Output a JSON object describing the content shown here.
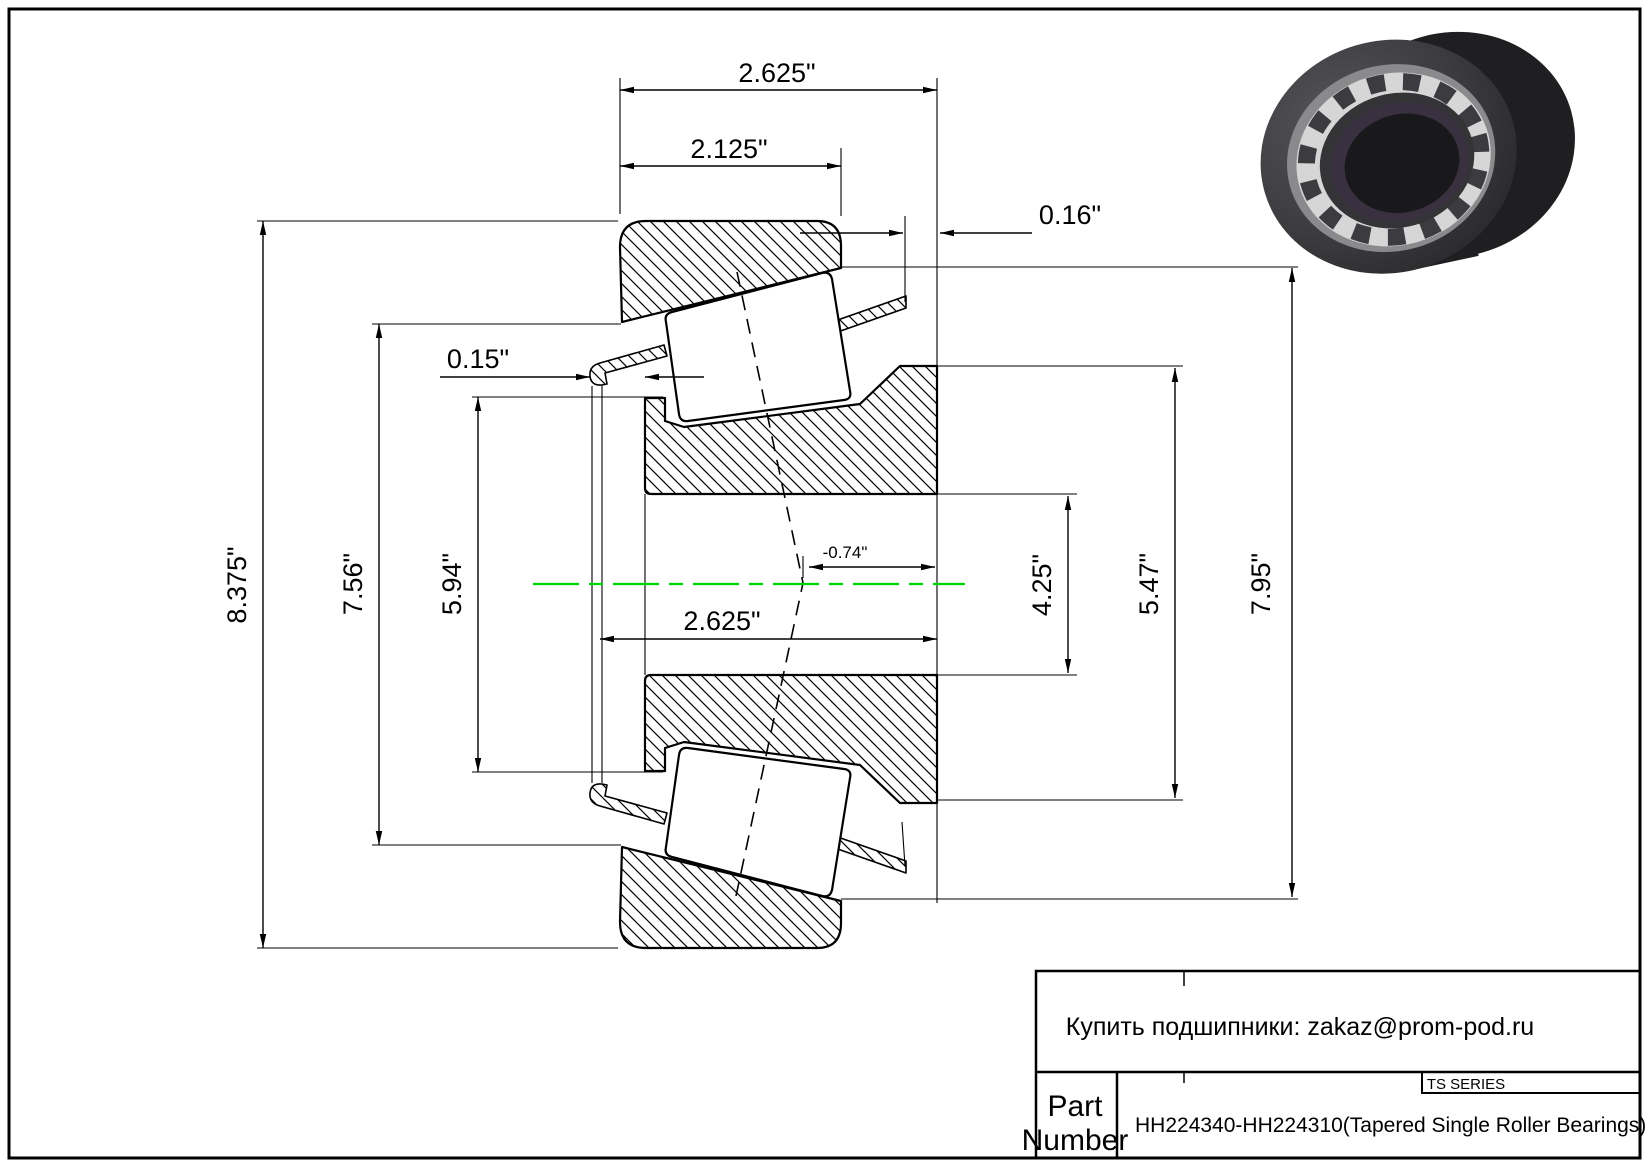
{
  "drawing": {
    "dims": {
      "cup_total_width": "2.625\"",
      "cup_front_width": "2.125\"",
      "cage_right_protrusion": "0.16\"",
      "cage_left_protrusion": "0.15\"",
      "outer_diameter": "8.375\"",
      "cup_small_inner_diameter": "7.56\"",
      "cone_front_diameter": "5.94\"",
      "cone_width": "2.625\"",
      "effective_center_offset": "-0.74\"",
      "bore_diameter": "4.25\"",
      "cone_rib_diameter": "5.47\"",
      "cup_large_inner_diameter": "7.95\""
    },
    "centerline_color": "#00d400"
  },
  "title_block": {
    "contact_note": "Купить подшипники: zakaz@prom-pod.ru",
    "series_label": "TS SERIES",
    "part_label_line1": "Part",
    "part_label_line2": "Number",
    "part_number": "HH224340-HH224310(Tapered Single Roller Bearings)"
  }
}
